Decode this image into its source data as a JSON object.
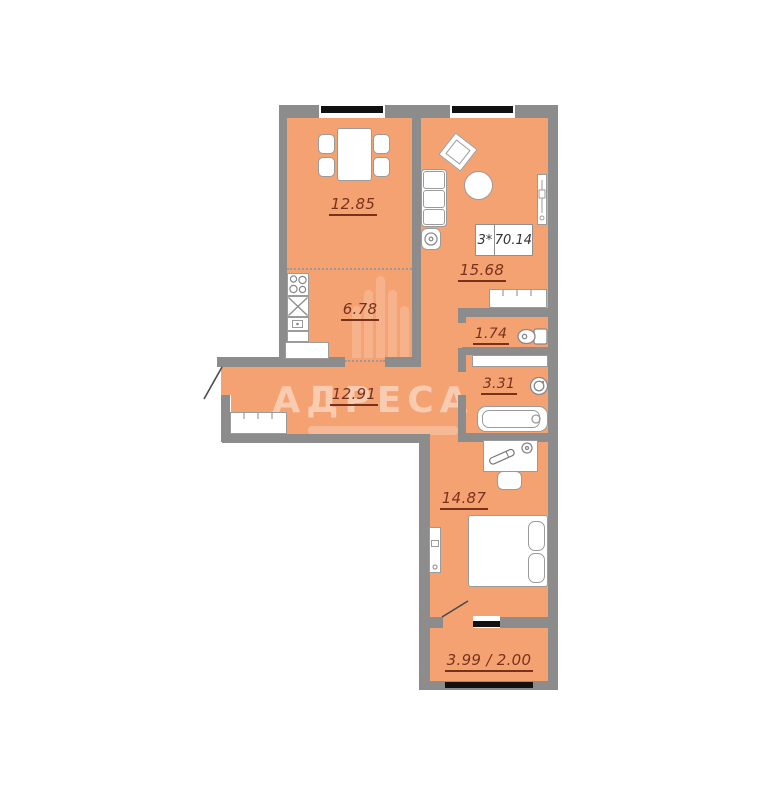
{
  "floorplan": {
    "title_box": {
      "rooms": "3*",
      "area": "70.14"
    },
    "watermark": {
      "text": "АДРЕСА"
    },
    "rooms": [
      {
        "id": "dining",
        "area": "12.85"
      },
      {
        "id": "kitchen",
        "area": "6.78"
      },
      {
        "id": "living",
        "area": "15.68"
      },
      {
        "id": "hallway",
        "area": "12.91"
      },
      {
        "id": "wc",
        "area": "1.74"
      },
      {
        "id": "bathroom",
        "area": "3.31"
      },
      {
        "id": "bedroom",
        "area": "14.87"
      },
      {
        "id": "balcony",
        "area": "3.99 / 2.00"
      }
    ],
    "colors": {
      "floor": "#f5a272",
      "wall": "#8c8c8c",
      "label": "#78321c",
      "window": "#111111"
    }
  }
}
